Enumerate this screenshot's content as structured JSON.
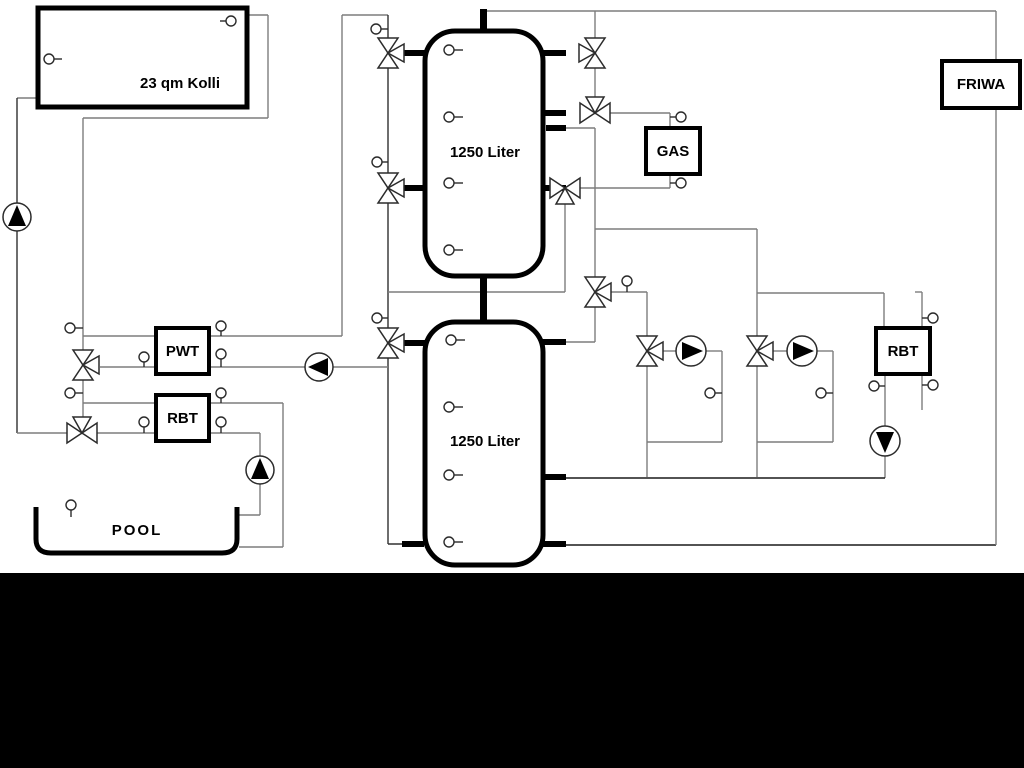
{
  "diagram": {
    "boxes": {
      "collector": "23 qm Kolli",
      "tank1": "1250 Liter",
      "tank2": "1250 Liter",
      "pwt": "PWT",
      "rbt_left": "RBT",
      "gas": "GAS",
      "friwa": "FRIWA",
      "rbt_right": "RBT",
      "pool": "POOL"
    },
    "colors": {
      "pipe_gray": "#7d7d7d",
      "outline_black": "#000000",
      "background": "#ffffff",
      "letterbox": "#000000"
    }
  }
}
